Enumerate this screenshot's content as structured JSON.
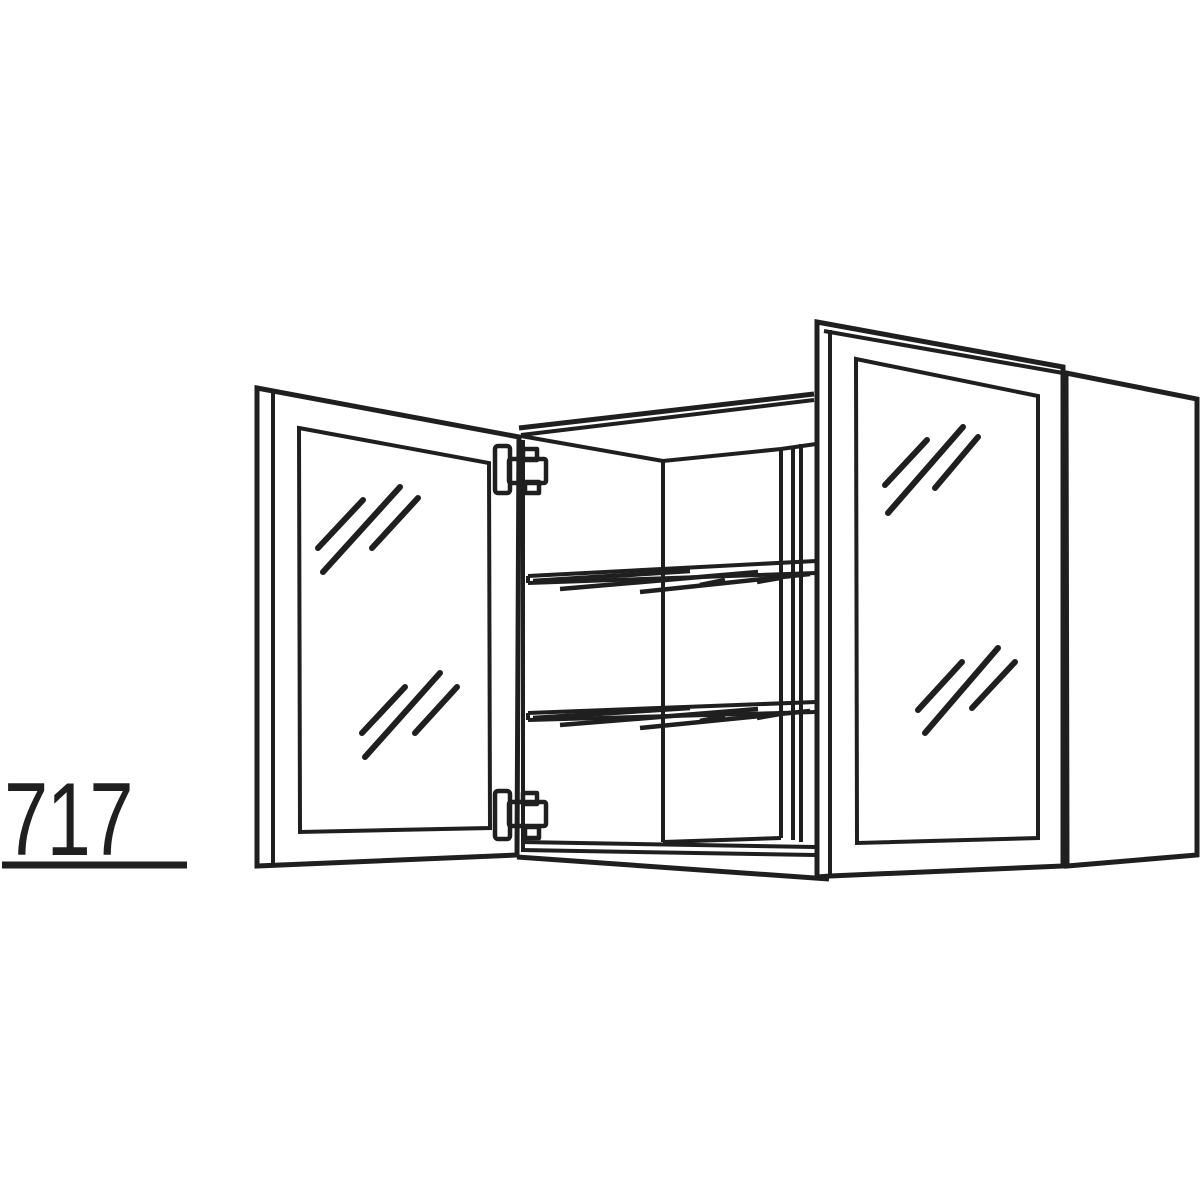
{
  "title": "Wall cabinet technical line drawing",
  "dimension_label": {
    "value": "717"
  },
  "colors": {
    "line": "#1f1f1f",
    "background": "#ffffff"
  },
  "drawing": {
    "type": "line-drawing",
    "subject": "double glass-door wall cabinet shown open",
    "components": [
      "left-glass-door",
      "right-glass-door",
      "cabinet-carcass",
      "upper-glass-shelf",
      "lower-glass-shelf",
      "top-hinge",
      "bottom-hinge",
      "right-side-panel"
    ],
    "door_count": 2,
    "shelf_count": 2,
    "hinge_count": 2
  }
}
